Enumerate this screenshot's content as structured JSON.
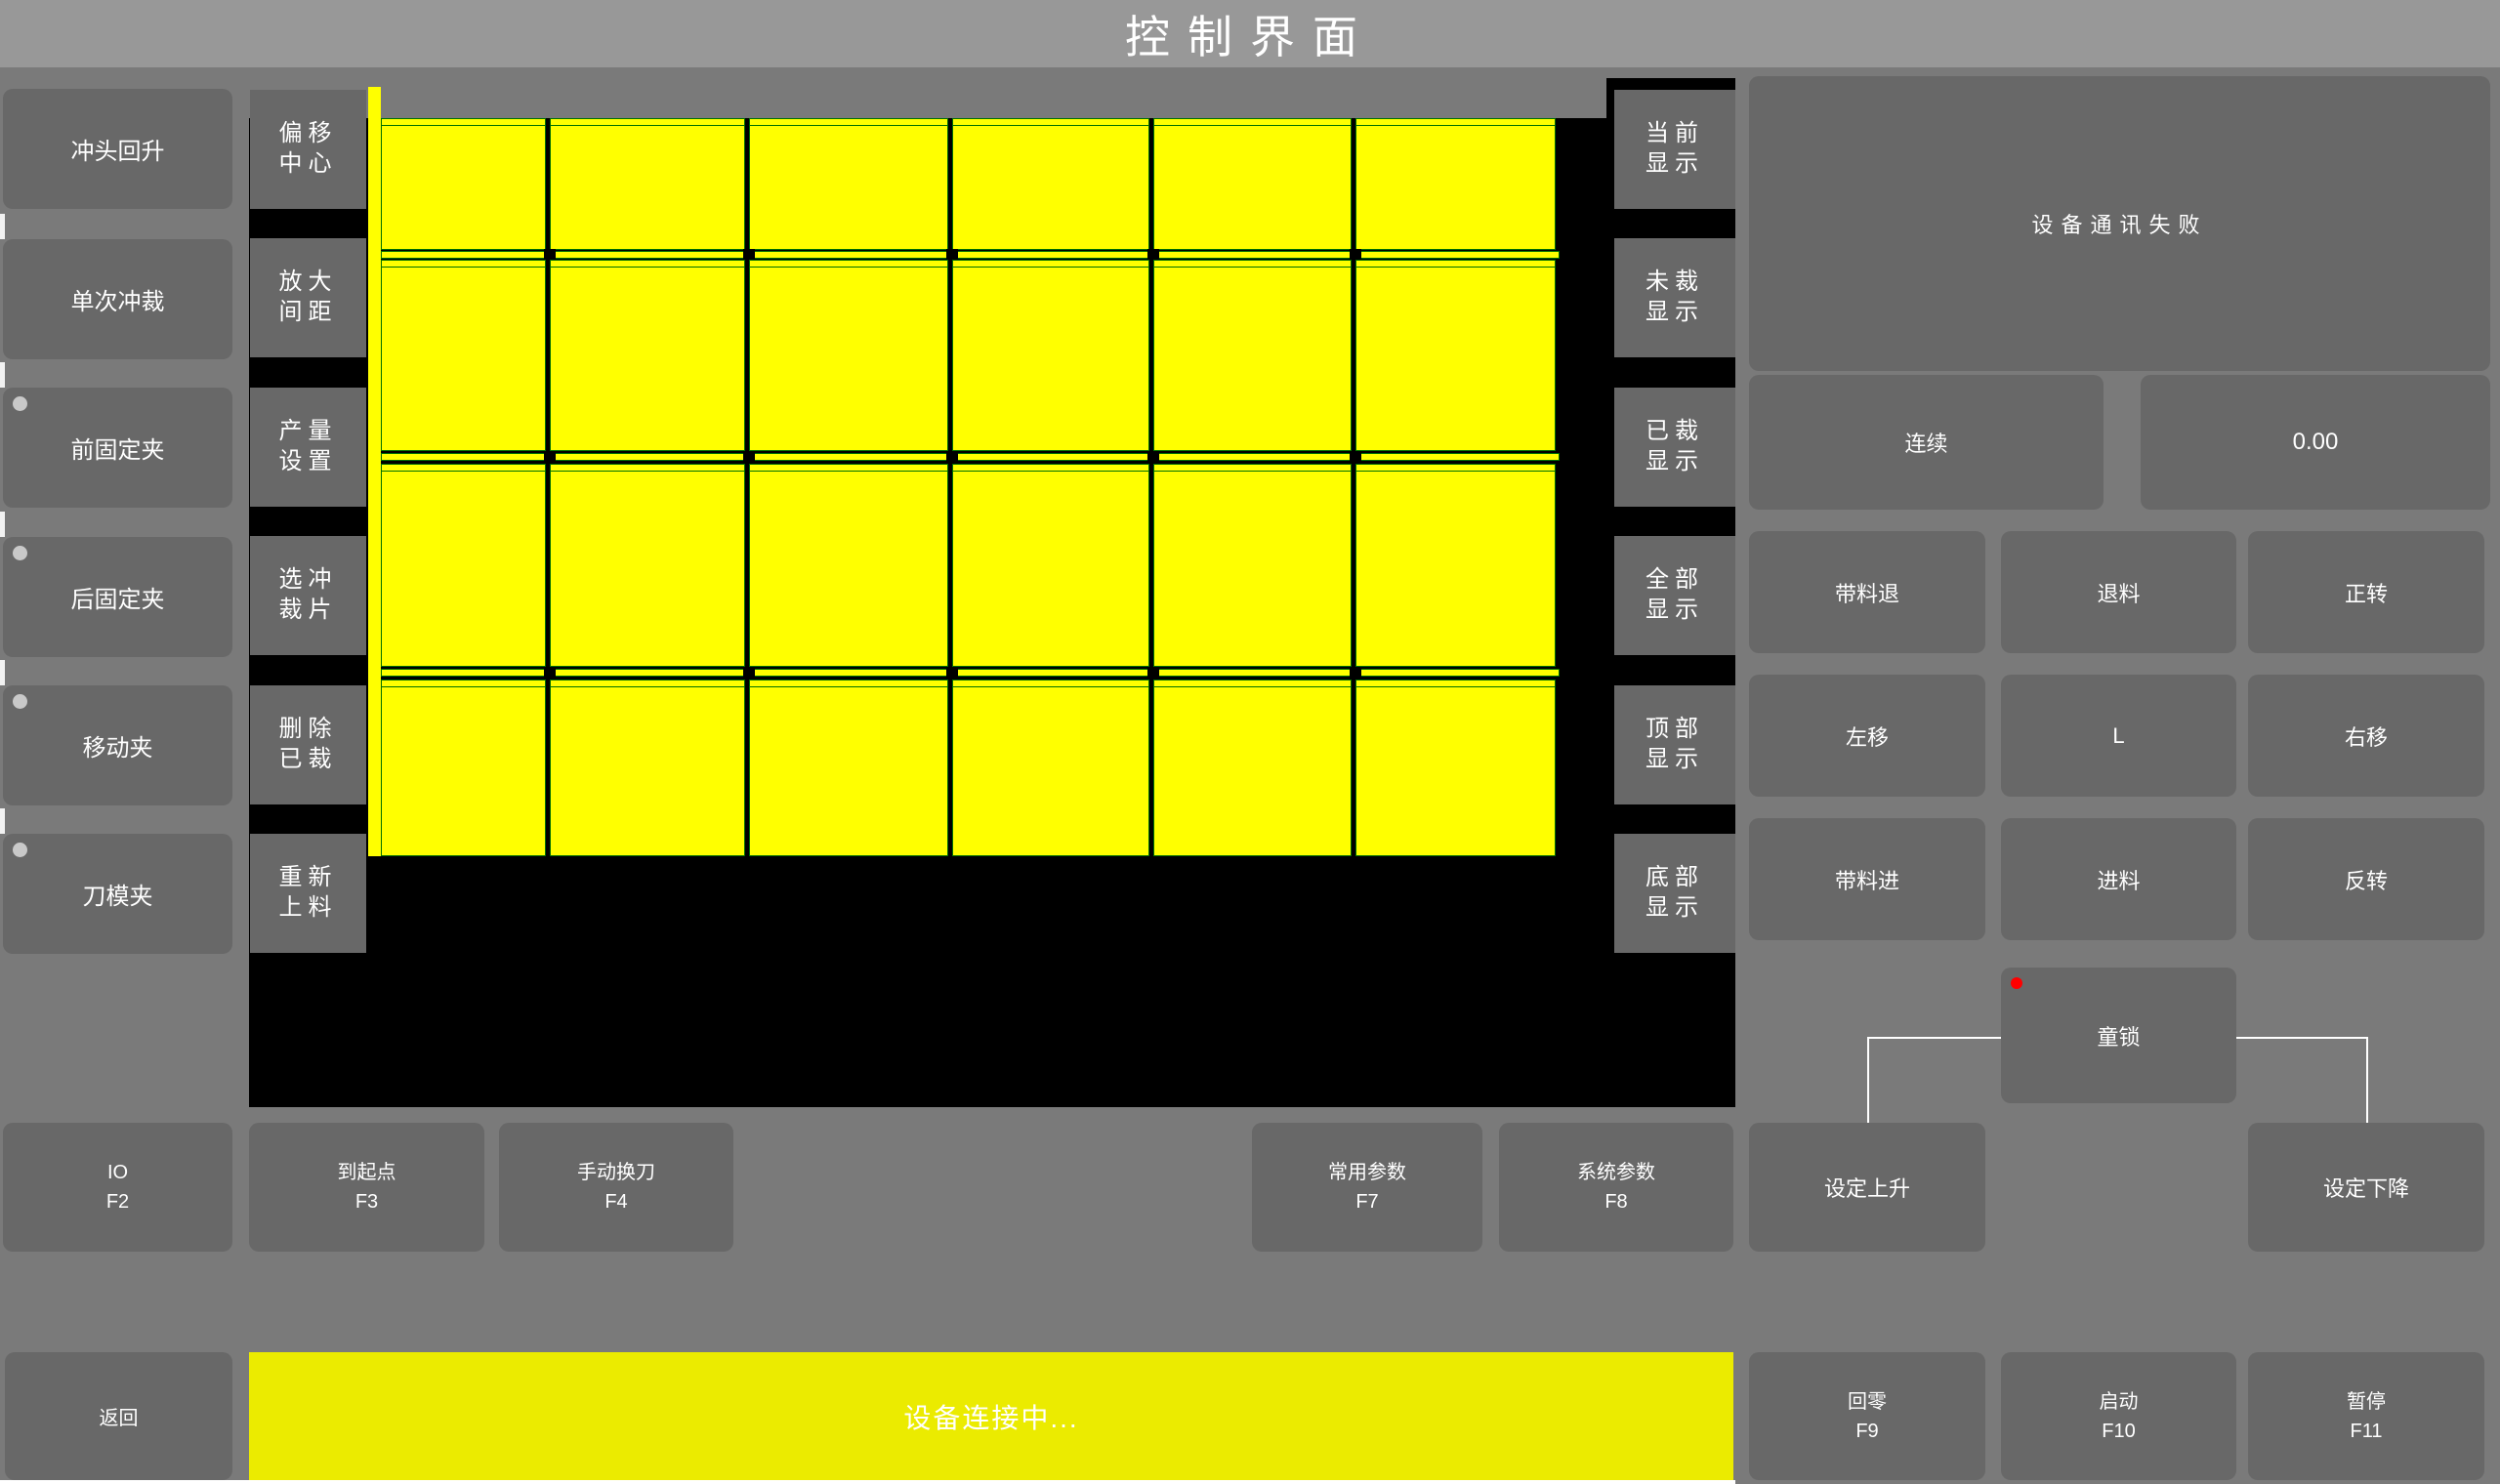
{
  "title": "控制界面",
  "left_sidebar": {
    "items": [
      {
        "label": "冲头回升",
        "indicator": false
      },
      {
        "label": "单次冲裁",
        "indicator": false
      },
      {
        "label": "前固定夹",
        "indicator": true
      },
      {
        "label": "后固定夹",
        "indicator": true
      },
      {
        "label": "移动夹",
        "indicator": true
      },
      {
        "label": "刀模夹",
        "indicator": true
      }
    ]
  },
  "canvas_sidebar": {
    "items": [
      {
        "line1": "偏移",
        "line2": "中心"
      },
      {
        "line1": "放大",
        "line2": "间距"
      },
      {
        "line1": "产量",
        "line2": "设置"
      },
      {
        "line1": "选冲",
        "line2": "裁片"
      },
      {
        "line1": "删除",
        "line2": "已裁"
      },
      {
        "line1": "重新",
        "line2": "上料"
      }
    ]
  },
  "display_sidebar": {
    "items": [
      {
        "line1": "当前",
        "line2": "显示"
      },
      {
        "line1": "未裁",
        "line2": "显示"
      },
      {
        "line1": "已裁",
        "line2": "显示"
      },
      {
        "line1": "全部",
        "line2": "显示"
      },
      {
        "line1": "顶部",
        "line2": "显示"
      },
      {
        "line1": "底部",
        "line2": "显示"
      }
    ]
  },
  "right_panel": {
    "status_message": "设备通讯失败",
    "continuous_label": "连续",
    "value_display": "0.00",
    "jog_grid": [
      [
        "带料退",
        "退料",
        "正转"
      ],
      [
        "左移",
        "L",
        "右移"
      ],
      [
        "带料进",
        "进料",
        "反转"
      ]
    ],
    "child_lock_label": "童锁"
  },
  "function_row": {
    "io": {
      "label": "IO",
      "fkey": "F2"
    },
    "to_origin": {
      "label": "到起点",
      "fkey": "F3"
    },
    "manual_tool_change": {
      "label": "手动换刀",
      "fkey": "F4"
    },
    "common_params": {
      "label": "常用参数",
      "fkey": "F7"
    },
    "system_params": {
      "label": "系统参数",
      "fkey": "F8"
    },
    "set_rise": {
      "label": "设定上升"
    },
    "set_fall": {
      "label": "设定下降"
    }
  },
  "bottom_bar": {
    "back_label": "返回",
    "status_text": "设备连接中...",
    "home": {
      "label": "回零",
      "fkey": "F9"
    },
    "start": {
      "label": "启动",
      "fkey": "F10"
    },
    "pause": {
      "label": "暂停",
      "fkey": "F11"
    }
  },
  "colors": {
    "sheet_yellow": "#ffff00",
    "status_bar_yellow": "#ebeb00",
    "outline_green": "#007000",
    "alert_red": "#ff0000",
    "background_gray": "#7a7a7a",
    "button_gray": "#686868",
    "titlebar_gray": "#989898"
  }
}
